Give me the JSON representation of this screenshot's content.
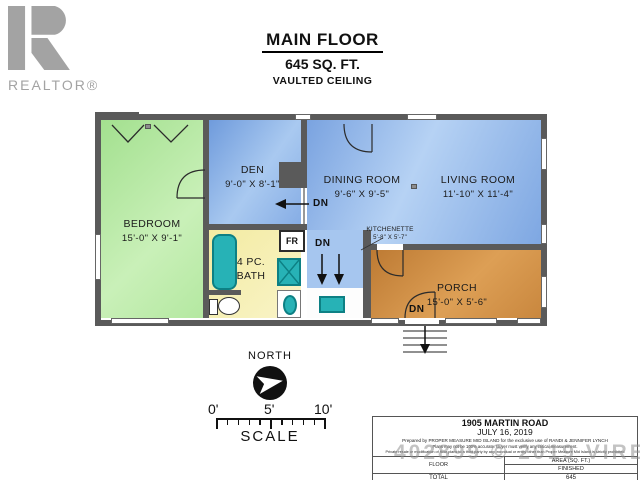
{
  "header": {
    "title": "MAIN FLOOR",
    "subtitle": "645 SQ. FT.",
    "subtitle2": "VAULTED CEILING"
  },
  "logo": {
    "brand": "REALTOR®"
  },
  "rooms": {
    "bedroom": {
      "name": "BEDROOM",
      "dims": "15'-0\" X 9'-1\""
    },
    "den": {
      "name": "DEN",
      "dims": "9'-0\" X 8'-1\""
    },
    "dining": {
      "name": "DINING ROOM",
      "dims": "9'-6\" X 9'-5\""
    },
    "living": {
      "name": "LIVING ROOM",
      "dims": "11'-10\" X 11'-4\""
    },
    "kitchenette": {
      "name": "KITCHENETTE",
      "dims": "5'-8\" X 5'-7\""
    },
    "bath": {
      "line1": "4 PC.",
      "line2": "BATH"
    },
    "porch": {
      "name": "PORCH",
      "dims": "15'-0\" X 5'-6\""
    }
  },
  "labels": {
    "dn": "DN",
    "fridge": "FR",
    "north": "NORTH",
    "scale": "SCALE",
    "tick0": "0'",
    "tick5": "5'",
    "tick10": "10'"
  },
  "info_box": {
    "address": "1905 MARTIN ROAD",
    "date": "JULY 16, 2019",
    "disclaimer1": "Prepared by PROPER MEASURE MID ISLAND for the exclusive use of RANDI & JENNIFER LYNCH",
    "disclaimer2": "Plans may not be 100% accurate. Buyer must verify any critical measurement.",
    "disclaimer3": "Private resale or modification of floor plans to a third party by any individual or entity other than Proper Measure Mid Island is strictly prohibited",
    "table": {
      "col1_header": "FLOOR",
      "col2_header": "AREA (SQ. FT.)",
      "finished_label": "FINISHED",
      "total_label": "TOTAL",
      "total_value": "645"
    }
  },
  "watermark": "402899 © 2019 VIREB",
  "colors": {
    "bedroom_green": "#b4e8a1",
    "room_blue": "#8fb4e8",
    "bath_yellow": "#f6efae",
    "porch_brown": "#cd8b42",
    "fixture_teal": "#27b2b6",
    "wall_gray": "#5a5a5a",
    "logo_gray": "#a3a3a3",
    "watermark_gray": "#919191"
  }
}
